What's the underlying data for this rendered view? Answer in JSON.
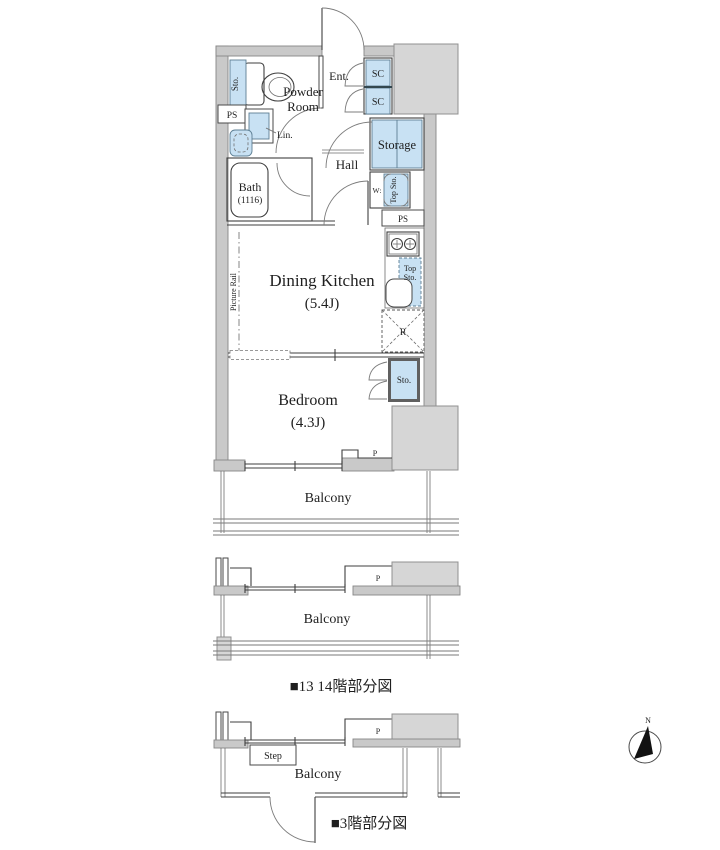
{
  "colors": {
    "fixture_blue": "#c8e1f3",
    "wall_gray": "#c9c9c9",
    "block_gray": "#d6d6d6",
    "line": "#3f3f3f",
    "fixture_stroke": "#5d7f94"
  },
  "main_plan": {
    "entrance": {
      "label": "Ent.",
      "sc_upper": "SC",
      "sc_lower": "SC"
    },
    "powder_room": {
      "line1": "Powder",
      "line2": "Room",
      "storage": "Sto.",
      "pipe_space": "PS",
      "linen": "Lin."
    },
    "bath": {
      "label": "Bath",
      "size": "(1116)"
    },
    "hall": {
      "label": "Hall",
      "storage": "Storage"
    },
    "laundry": {
      "washer": "W:",
      "top_storage": "Top Sto."
    },
    "kitchen": {
      "pipe_space": "PS",
      "top_storage_1": "Top",
      "top_storage_2": "Sto.",
      "refrigerator": "R"
    },
    "dining_kitchen": {
      "label": "Dining Kitchen",
      "size": "(5.4J)",
      "picture_rail": "Picture Rail"
    },
    "bedroom": {
      "label": "Bedroom",
      "size": "(4.3J)",
      "storage": "Sto.",
      "pillar": "P"
    },
    "balcony": {
      "label": "Balcony"
    }
  },
  "plan_13_14": {
    "pillar": "P",
    "balcony": "Balcony",
    "caption": "■13 14階部分図"
  },
  "plan_3": {
    "pillar": "P",
    "step": "Step",
    "balcony": "Balcony",
    "caption": "■3階部分図"
  },
  "compass": {
    "north": "N"
  }
}
